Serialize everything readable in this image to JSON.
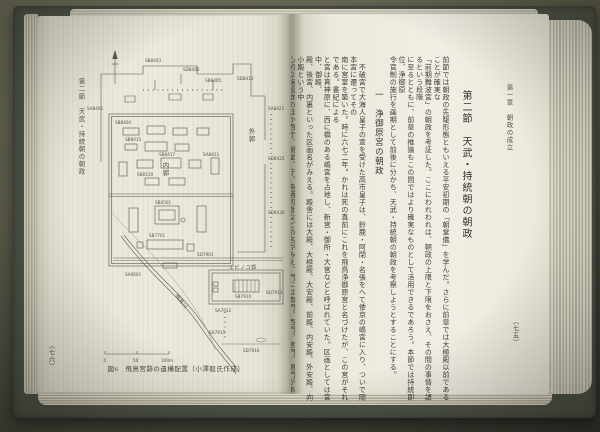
{
  "colors": {
    "paper": "#efede1",
    "cover": "#4d5247",
    "background": "#5c5b4e",
    "ink": "#3f3e3a",
    "plan_ink": "#55524c"
  },
  "left_page": {
    "margin_header": "第二節　天武・持統朝の朝政",
    "page_number": "（七六）",
    "figure": {
      "caption": "図6　飛鳥宮跡の遺構配置（小澤毅氏作成）",
      "labels": {
        "inner_enclosure": "内郭",
        "outer_enclosure": "外郭",
        "ebinoko_enclosure": "エビノコ郭",
        "river": "飛鳥川"
      },
      "scale": {
        "zero": "0",
        "fifty": "50",
        "hundred": "100m"
      },
      "features": [
        "SB8403",
        "SD8406",
        "SB8405",
        "SA8401",
        "SD8410",
        "SA8421",
        "SD8425",
        "SB0501",
        "SB7701",
        "SA0601",
        "SD7901",
        "SB8415",
        "SB8417",
        "SA8431",
        "SK8119",
        "SB7910",
        "SA7912",
        "SD7913",
        "SA7915",
        "SD7916",
        "SB8404",
        "SD8430"
      ]
    }
  },
  "right_page": {
    "running_header": "第一章　朝政の成立",
    "page_number": "（七五）",
    "section_title": "第二節　天武・持統朝の朝政",
    "subsection_title": "一　浄御原宮の朝政",
    "intro_text": "前節では朝政の先駆形態ともいえる平安初期の「朝堂儀」を学んだ。さらに前章では大極殿以前であることが確実な\n「前期難波宮」の朝政を考証した。ここにわれわれは、朝政の上限と下限をおさえ、その間の事情を語るという段階\nに至るとともに、前章の推論もこの間ではより確実なものとして活用できるであろう。本節では持統即位、浄御原\n令官制の施行を画期として前後に分かち、天武・持統朝の朝政を考察しようとすることにする。",
    "body_text": "　不破宮で大海人皇子の宣を受けた高市皇子は、鈴鹿・阿閉・名張をへて倭京の嶋宮に入り、ついで岡本宮に遷ってその\n南に宮室を築いた。時に六七二年。かれは死の直前にこれを飛鳥浄御原宮と名づけたが、この宮がそれである。書紀による\nと宮は真神原に、西に橋のある嶋宮を占地し、新宮・御所・大宮などと呼ばれていた。区画としては宮中、御殿、\n殿、後宮、内裏といった区画名がみえる。殿舎には大殿、大極殿、大安殿、前殿、内安殿、外安殿、向小殿という中\n心的な施設群のほか西庁、朝堂、庁、造酒司倉などの名がみえ、門には南門、西門、宮門、閤門があり、ほかに\n朝庭、庭中の名がみえる。むろんこれらの名称には精査を加えねばならない。いま大勢の論にしたがって、これ\nを飛鳥京跡（三期・伝飛鳥板蓋宮）の上層遺構とみることとし、持統八年（六九四）に遷る藤原宮と対比しつつ、\n宮殿の景観をたどってみよう。すなわち飛鳥宮跡は内郭、エビノコ郭、外郭から成るが、内郭は内裏\nにあたってもその南北には殿舎を分かつ廻廊がなく、閤門・南門・大門と殿舎とをつづけて配置するにすぎない。内\n郭の南半には前殿とよばれる四面庇の大建物があり、その南に広場を隔てて南門が開く。エビノコ郭の大殿は\n一段と高大であり、大極殿の前身とみる説が有力である。朝政の場をどこに求めるかは、これらの殿舎の性格\nづけと深くかかわるのであって、内郭前殿説・エビノコ大殿説のそれぞれになお検討の余地が残されている。"
  }
}
